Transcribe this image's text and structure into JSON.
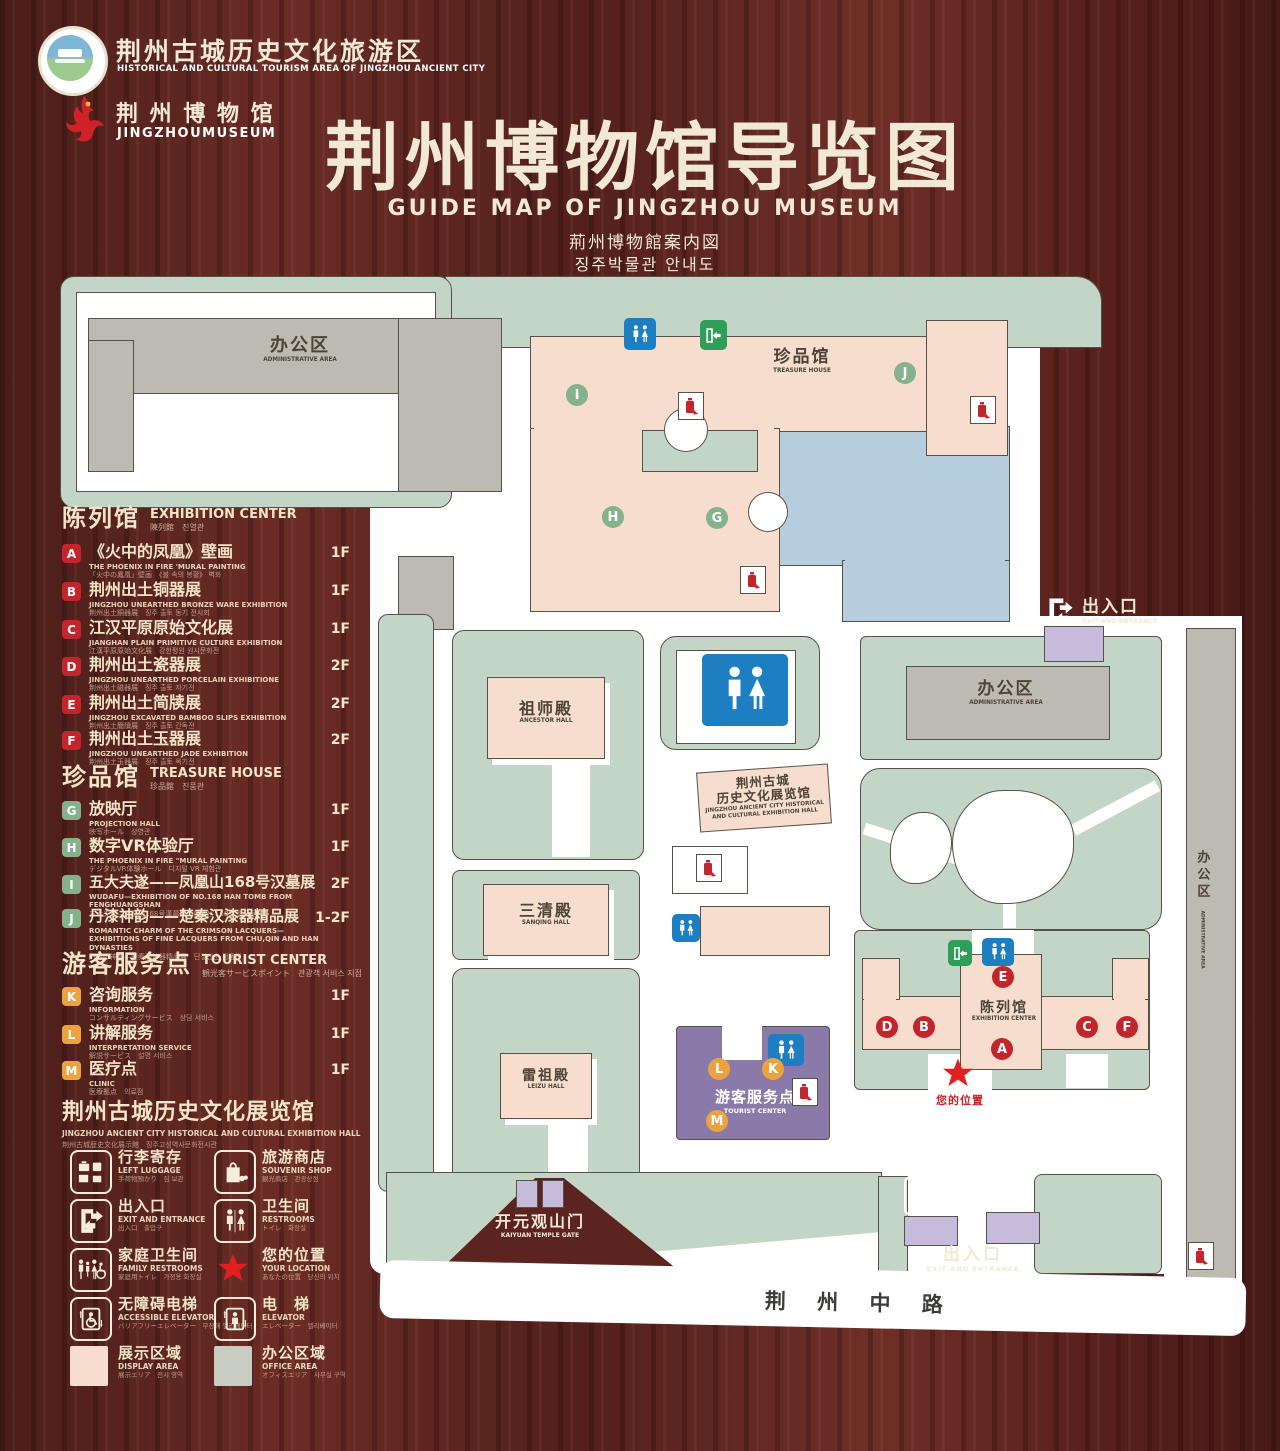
{
  "header": {
    "logo1": {
      "zh": "荆州古城历史文化旅游区",
      "en": "HISTORICAL AND CULTURAL TOURISM AREA OF JINGZHOU ANCIENT CITY"
    },
    "logo2": {
      "zh": "荆 州 博 物 馆",
      "en": "JINGZHOUMUSEUM"
    },
    "title": "荆州博物馆导览图",
    "subtitle_en": "GUIDE MAP OF JINGZHOU MUSEUM",
    "subtitle_ja": "荊州博物館案内図",
    "subtitle_ko": "징주박물관 안내도"
  },
  "sidebar": {
    "exhibition": {
      "zh": "陈列馆",
      "en": "EXHIBITION CENTER",
      "sub": "陳列館　진열관",
      "items": [
        {
          "letter": "A",
          "zh": "《火中的凤凰》壁画",
          "en": "THE PHOENIX IN FIRE 'MURAL PAINTING",
          "jk": "「火中の鳳凰」壁画　《불 속의 봉황》 벽화",
          "floor": "1F"
        },
        {
          "letter": "B",
          "zh": "荆州出土铜器展",
          "en": "JINGZHOU UNEARTHED BRONZE WARE EXHIBITION",
          "jk": "荆州出土銅器展　징주 출토 동기 전시회",
          "floor": "1F"
        },
        {
          "letter": "C",
          "zh": "江汉平原原始文化展",
          "en": "JIANGHAN PLAIN PRIMITIVE CULTURE EXHIBITION",
          "jk": "江漢平原原始文化展　강한평원 원시문화전",
          "floor": "1F"
        },
        {
          "letter": "D",
          "zh": "荆州出土瓷器展",
          "en": "JINGZHOU UNEARTHED PORCELAIN EXHIBITIONE",
          "jk": "荆州出土磁器展　징주 출토 자기전",
          "floor": "2F"
        },
        {
          "letter": "E",
          "zh": "荆州出土简牍展",
          "en": "JINGZHOU EXCAVATED BAMBOO SLIPS EXHIBITION",
          "jk": "荆州出土簡牘展　징주 출토 간독전",
          "floor": "2F"
        },
        {
          "letter": "F",
          "zh": "荆州出土玉器展",
          "en": "JINGZHOU UNEARTHED JADE EXHIBITION",
          "jk": "荆州出土玉器展　징주 출토 옥기전",
          "floor": "2F"
        }
      ]
    },
    "treasure": {
      "zh": "珍品馆",
      "en": "TREASURE HOUSE",
      "sub": "珍品館　진품관",
      "items": [
        {
          "letter": "G",
          "zh": "放映厅",
          "en": "PROJECTION HALL",
          "jk": "映写ホール　상영관",
          "floor": "1F"
        },
        {
          "letter": "H",
          "zh": "数字VR体验厅",
          "en": "THE PHOENIX IN FIRE \"MURAL PAINTING",
          "jk": "デジタルVR体験ホール　디지털 VR 체험관",
          "floor": "1F"
        },
        {
          "letter": "I",
          "zh": "五大夫遂——凤凰山168号汉墓展",
          "en": "WUDAFU—EXHIBITION OF NO.168 HAN TOMB FROM FENGHUANGSHAN",
          "jk": "五大夫遂—鳳凰山168号漢墓展　봉황산 168호 한묘전",
          "floor": "2F"
        },
        {
          "letter": "J",
          "zh": "丹漆神韵——楚秦汉漆器精品展",
          "en": "ROMANTIC CHARM OF THE CRIMSON LACQUERS— EXHIBITIONS OF FINE LACQUERS FROM CHU,QIN AND HAN DYNASTIES",
          "jk": "丹漆の神韻—楚秦漢漆器精品展　단칠신운 정품전",
          "floor": "1-2F"
        }
      ]
    },
    "tourist": {
      "zh": "游客服务点",
      "en": "TOURIST CENTER",
      "sub": "観光客サービスポイント　관광객 서비스 지점",
      "items": [
        {
          "letter": "K",
          "zh": "咨询服务",
          "en": "INFORMATION",
          "jk": "コンサルティングサービス　상담 서비스",
          "floor": "1F"
        },
        {
          "letter": "L",
          "zh": "讲解服务",
          "en": "INTERPRETATION SERVICE",
          "jk": "解説サービス　설명 서비스",
          "floor": "1F"
        },
        {
          "letter": "M",
          "zh": "医疗点",
          "en": "CLINIC",
          "jk": "医療拠点　의료점",
          "floor": "1F"
        }
      ]
    },
    "hall_note": {
      "zh": "荆州古城历史文化展览馆",
      "en": "JINGZHOU ANCIENT CITY HISTORICAL AND CULTURAL EXHIBITION HALL",
      "jk": "荆州古城歴史文化展示館　징주고성역사문화전시관"
    }
  },
  "legend": {
    "items": [
      {
        "icon": "left-luggage",
        "zh": "行李寄存",
        "en": "LEFT LUGGAGE",
        "jk": "手荷物預かり　짐 보관"
      },
      {
        "icon": "souvenir-shop",
        "zh": "旅游商店",
        "en": "SOUVENIR SHOP",
        "jk": "観光商店　관광상점"
      },
      {
        "icon": "exit-entrance",
        "zh": "出入口",
        "en": "EXIT AND ENTRANCE",
        "jk": "出入口　출입구"
      },
      {
        "icon": "restrooms",
        "zh": "卫生间",
        "en": "RESTROOMS",
        "jk": "トイレ　화장실"
      },
      {
        "icon": "family-restrooms",
        "zh": "家庭卫生间",
        "en": "FAMILY RESTROOMS",
        "jk": "家庭用トイレ　가정용 화장실"
      },
      {
        "icon": "your-location",
        "zh": "您的位置",
        "en": "YOUR LOCATION",
        "jk": "あなたの位置　당신의 위치"
      },
      {
        "icon": "accessible-elevator",
        "zh": "无障碍电梯",
        "en": "ACCESSIBLE ELEVATOR",
        "jk": "バリアフリーエレベーター　무장애 엘리베이터"
      },
      {
        "icon": "elevator",
        "zh": "电　梯",
        "en": "ELEVATOR",
        "jk": "エレベーター　엘리베이터"
      },
      {
        "icon": "display-area",
        "zh": "展示区域",
        "en": "DISPLAY AREA",
        "jk": "展示エリア　전시 영역"
      },
      {
        "icon": "office-area",
        "zh": "办公区域",
        "en": "OFFICE AREA",
        "jk": "オフィスエリア　사무실 구역"
      }
    ]
  },
  "map": {
    "admin_nw": {
      "zh": "办公区",
      "en": "ADMINISTRATIVE AREA"
    },
    "treasure": {
      "zh": "珍品馆",
      "en": "TREASURE HOUSE"
    },
    "ancestor": {
      "zh": "祖师殿",
      "en": "ANCESTOR HALL"
    },
    "sanqing": {
      "zh": "三清殿",
      "en": "SANQING HALL"
    },
    "leizu": {
      "zh": "雷祖殿",
      "en": "LEIZU HALL"
    },
    "history_hall": {
      "zh1": "荆州古城",
      "zh2": "历史文化展览馆",
      "en1": "JINGZHOU ANCIENT CITY HISTORICAL",
      "en2": "AND CULTURAL EXHIBITION HALL"
    },
    "admin_e": {
      "zh": "办公区",
      "en": "ADMINISTRATIVE AREA"
    },
    "admin_strip": {
      "zh": "办公区",
      "en": "ADMINISTRATIVE AREA"
    },
    "exhibition": {
      "zh": "陈列馆",
      "en": "EXHIBITION CENTER"
    },
    "tourist": {
      "zh": "游客服务点",
      "en": "TOURIST CENTER"
    },
    "exit_east": {
      "zh": "出入口",
      "en": "EXIT AND ENTRANCE"
    },
    "exit_south": {
      "zh": "出入口",
      "en": "EXIT AND ENTRANCE"
    },
    "gate": {
      "zh": "开元观山门",
      "en": "KAIYUAN TEMPLE GATE"
    },
    "your_location": "您的位置",
    "road": "荆 州 中 路",
    "badges": [
      "I",
      "H",
      "G",
      "J",
      "E",
      "D",
      "B",
      "A",
      "C",
      "F",
      "K",
      "L",
      "M"
    ]
  },
  "colors": {
    "wood": "#5c2420",
    "cream": "#f2e9d5",
    "building_pink": "#f6ddce",
    "lawn_green": "#c2d5c6",
    "office_gray": "#bdbab1",
    "lake_blue": "#b6cddd",
    "tourist_purple": "#8a7aaa",
    "gate_purple": "#c6bbdb",
    "restroom_blue": "#1d7ec2",
    "exit_green": "#2f9e59",
    "badge_red": "#c2262c",
    "badge_green": "#85b28c",
    "badge_orange": "#eca33f",
    "location_red": "#e01f1f"
  },
  "icons": {
    "restroom": "man-woman pictogram",
    "exit_sign": "running-man door",
    "fire_point": "fire-extinguisher",
    "location": "red star",
    "elevator": "up-down arrows",
    "luggage": "suitcases",
    "family_restroom": "family pictogram"
  }
}
